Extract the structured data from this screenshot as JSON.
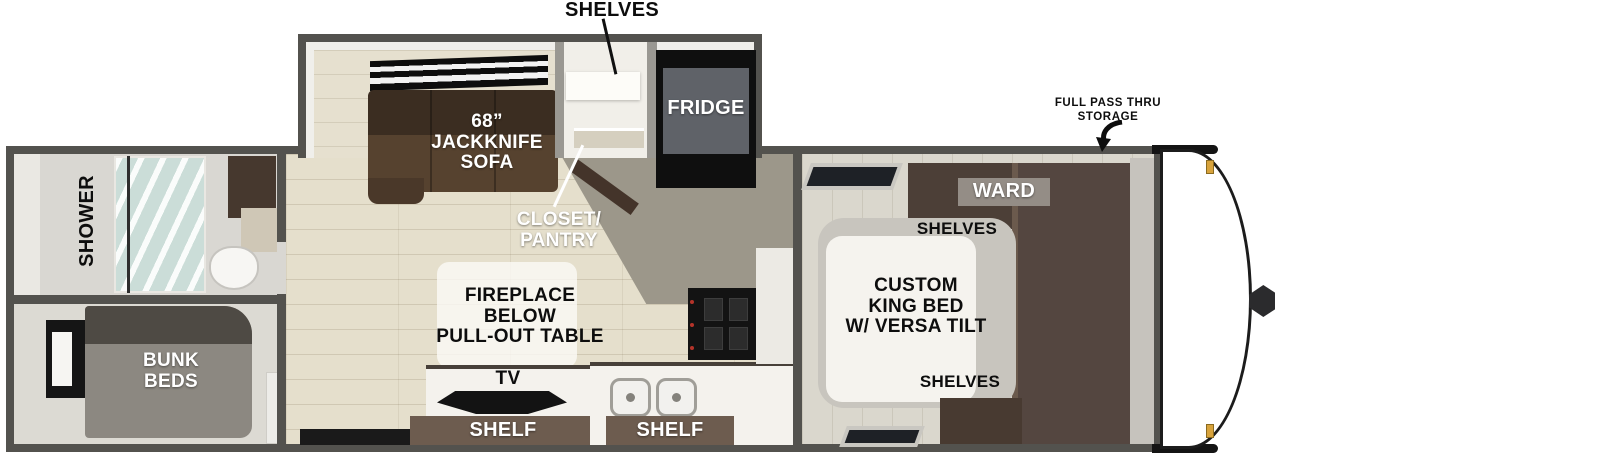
{
  "plan": {
    "slideout": {
      "shelves_pointer_label": "SHELVES",
      "sofa_label": [
        "68”",
        "JACKKNIFE",
        "SOFA"
      ],
      "fridge_label": "FRIDGE"
    },
    "kitchen": {
      "closet_label": [
        "CLOSET/",
        "PANTRY"
      ],
      "fireplace_label": [
        "FIREPLACE",
        "BELOW",
        "PULL-OUT TABLE"
      ],
      "tv_label": "TV",
      "shelf_left_label": "SHELF",
      "shelf_right_label": "SHELF"
    },
    "bathroom": {
      "shower_label": "SHOWER"
    },
    "bunk_room": {
      "bunk_label": [
        "BUNK",
        "BEDS"
      ]
    },
    "bedroom": {
      "bed_label": [
        "CUSTOM",
        "KING BED",
        "W/ VERSA TILT"
      ],
      "ward_label": "WARD",
      "shelves_top_label": "SHELVES",
      "shelves_bottom_label": "SHELVES"
    },
    "front": {
      "storage_label": [
        "FULL PASS THRU",
        "STORAGE"
      ]
    },
    "colors": {
      "wall": "#53524e",
      "floor_plank": "#e5dfcc",
      "floor_kitchen": "#9c978a",
      "floor_bedroom": "#dad7cd",
      "sofa_brown": "#3b2d21",
      "ward_brown": "#4c3f37",
      "shelf_brown": "#6d5c4f",
      "fridge_gray": "#5f6268",
      "bunk_gray": "#8c8881",
      "shower_glass": "#cfe0db",
      "cap_trim_black": "#141414",
      "clip_gold": "#d8a33c",
      "label_white": "#ffffff",
      "label_black": "#0d0d0d"
    }
  }
}
